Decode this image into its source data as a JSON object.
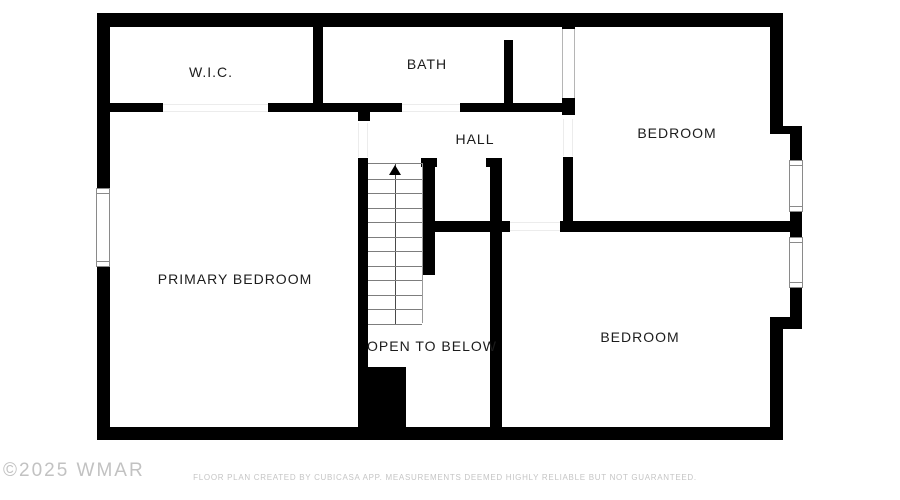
{
  "plan": {
    "type": "floor-plan",
    "colors": {
      "wall": "#000000",
      "background": "#ffffff",
      "label_text": "#1c1c1c",
      "stair_tread": "#7d7d7d",
      "watermark_text": "#c2c2c2",
      "disclaimer_text": "#c5c5c5"
    },
    "rooms": [
      {
        "label": "W.I.C."
      },
      {
        "label": "BATH"
      },
      {
        "label": "BEDROOM"
      },
      {
        "label": "HALL"
      },
      {
        "label": "PRIMARY BEDROOM"
      },
      {
        "label": "BEDROOM"
      }
    ],
    "stairs": {
      "label": "OPEN TO BELOW",
      "steps": 11,
      "direction": "up"
    },
    "windows_count": 3,
    "footer": {
      "watermark": "©2025 WMAR",
      "disclaimer": "FLOOR PLAN CREATED BY CUBICASA APP. MEASUREMENTS DEEMED HIGHLY RELIABLE BUT NOT GUARANTEED."
    }
  }
}
